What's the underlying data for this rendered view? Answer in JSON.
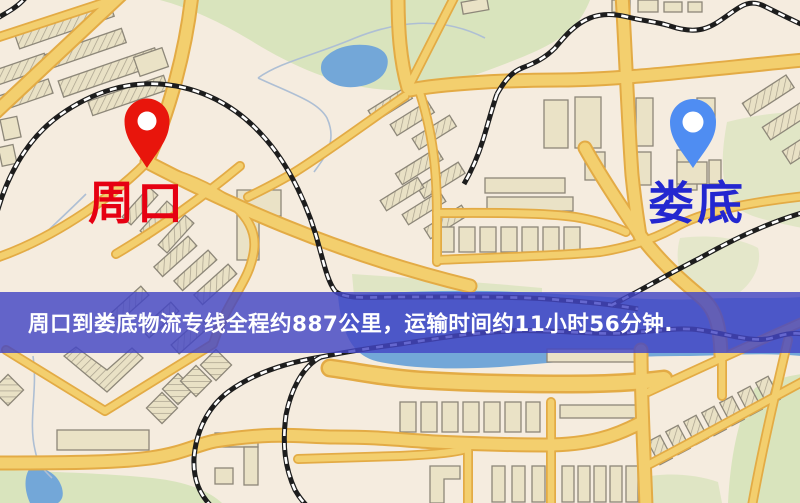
{
  "banner": {
    "text": "周口到娄底物流专线全程约887公里，运输时间约11小时56分钟.",
    "distance_km": "887",
    "duration_hours": "11",
    "duration_minutes": "56"
  },
  "map": {
    "origin": {
      "label": "周口"
    },
    "destination": {
      "label": "娄底"
    }
  },
  "colors": {
    "map_bg": "#f5ecdf",
    "park": "#d9e4bd",
    "water": "#73a7d8",
    "road_fill": "#f3cf6e",
    "road_casing": "#e3ab45",
    "rail": "#1d1d1d",
    "building": "#eae2c6",
    "banner_bg": "rgba(67,70,196,0.82)",
    "banner_text": "#ffffff",
    "pin_origin": "#e8150c",
    "pin_dest": "#4f8df2",
    "label_origin": "#e60012",
    "label_dest": "#2327d0"
  }
}
